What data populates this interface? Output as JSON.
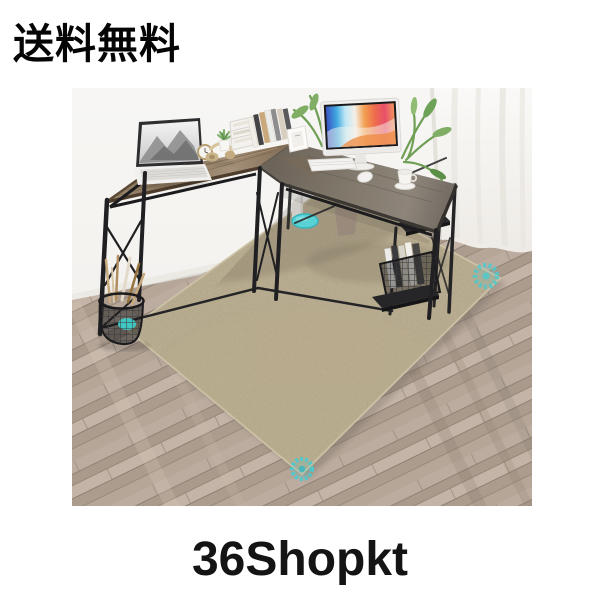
{
  "header": {
    "shipping_label": "送料無料"
  },
  "footer": {
    "brand": "36Shopkt"
  },
  "photo": {
    "alt": "L-shaped computer desk with storage shelves standing on a beige low-pile square area rug laid diagonally over taupe wood-plank flooring; teal anti-slip grip dots mark the rug corners; white curtain at right",
    "colors": {
      "page_background": "#ffffff",
      "wall": "#f5f3f0",
      "floor_base": "#b3a296",
      "rug": "#978866",
      "rug_binding": "#cfc5a9",
      "desk_left_top": "#8a7458",
      "desk_right_top": "#746c62",
      "desk_frame": "#202022",
      "grip_dot_teal": "#45cbd1",
      "curtain": "#f8f7f4"
    },
    "objects": [
      "laptop",
      "headphones",
      "alarm-clock",
      "succulent-pot",
      "desk-organizer",
      "books",
      "photo-frame",
      "palm-plant",
      "monitor",
      "keyboard",
      "mouse",
      "coffee-cup",
      "hanging-planter",
      "magazine-stack",
      "wire-magazine-basket",
      "pencil-wire-basket",
      "rug-grip-dots",
      "white-pole",
      "curtain"
    ]
  }
}
